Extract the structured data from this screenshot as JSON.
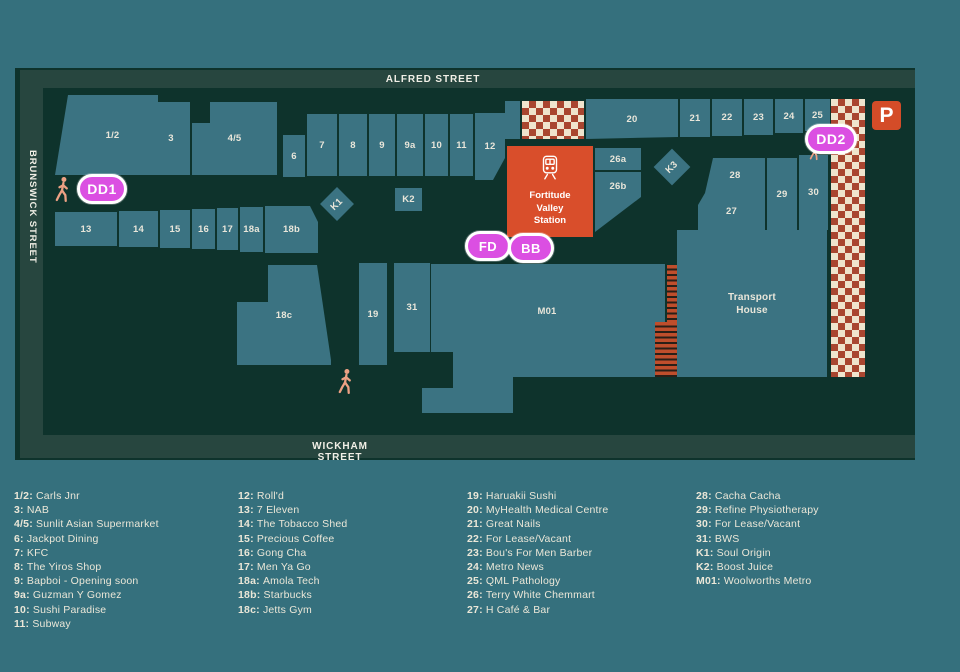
{
  "colors": {
    "bg": "#35707d",
    "map": "#0e332c",
    "band": "#27463f",
    "bld": "#3b7382",
    "label": "#e9e6da",
    "station": "#d94e2b",
    "checkerred": "#a94630",
    "checkercream": "#efe4cd",
    "stair": "#bf4e2c",
    "marker": "#db4fe2",
    "parking": "#d44c28",
    "person": "#eda184",
    "legendtext": "#ebe7d8"
  },
  "streets": {
    "top": "ALFRED STREET",
    "left": "BRUNSWICK STREET",
    "bottom": "WICKHAM STREET"
  },
  "station": {
    "name": "Fortitude\nValley\nStation"
  },
  "transport_house": {
    "name": "Transport\nHouse"
  },
  "parking": {
    "label": "P"
  },
  "markers": {
    "dd1": "DD1",
    "dd2": "DD2",
    "fd": "FD",
    "bb": "BB"
  },
  "buildings": {
    "u1_2": "1/2",
    "u3": "3",
    "u4_5": "4/5",
    "u6": "6",
    "u7": "7",
    "u8": "8",
    "u9": "9",
    "u9a": "9a",
    "u10": "10",
    "u11": "11",
    "u12": "12",
    "u13": "13",
    "u14": "14",
    "u15": "15",
    "u16": "16",
    "u17": "17",
    "u18a": "18a",
    "u18b": "18b",
    "u18c": "18c",
    "u19": "19",
    "u20": "20",
    "u21": "21",
    "u22": "22",
    "u23": "23",
    "u24": "24",
    "u25": "25",
    "u26a": "26a",
    "u26b": "26b",
    "u27": "27",
    "u28": "28",
    "u29": "29",
    "u30": "30",
    "u31": "31",
    "m01": "M01",
    "k1": "K1",
    "k2": "K2",
    "k3": "K3"
  },
  "legend": {
    "columns": [
      [
        {
          "n": "1/2",
          "t": "Carls Jnr"
        },
        {
          "n": "3",
          "t": "NAB"
        },
        {
          "n": "4/5",
          "t": "Sunlit Asian Supermarket"
        },
        {
          "n": "6",
          "t": "Jackpot Dining"
        },
        {
          "n": "7",
          "t": "KFC"
        },
        {
          "n": "8",
          "t": "The Yiros Shop"
        },
        {
          "n": "9",
          "t": "Bapboi - Opening soon"
        },
        {
          "n": "9a",
          "t": "Guzman Y Gomez"
        },
        {
          "n": "10",
          "t": "Sushi Paradise"
        },
        {
          "n": "11",
          "t": "Subway"
        }
      ],
      [
        {
          "n": "12",
          "t": "Roll'd"
        },
        {
          "n": "13",
          "t": "7 Eleven"
        },
        {
          "n": "14",
          "t": "The Tobacco Shed"
        },
        {
          "n": "15",
          "t": "Precious Coffee"
        },
        {
          "n": "16",
          "t": "Gong Cha"
        },
        {
          "n": "17",
          "t": "Men Ya Go"
        },
        {
          "n": "18a",
          "t": "Amola Tech"
        },
        {
          "n": "18b",
          "t": "Starbucks"
        },
        {
          "n": "18c",
          "t": "Jetts Gym"
        }
      ],
      [
        {
          "n": "19",
          "t": "Haruakii Sushi"
        },
        {
          "n": "20",
          "t": "MyHealth Medical Centre"
        },
        {
          "n": "21",
          "t": "Great Nails"
        },
        {
          "n": "22",
          "t": "For Lease/Vacant"
        },
        {
          "n": "23",
          "t": "Bou's For Men Barber"
        },
        {
          "n": "24",
          "t": "Metro News"
        },
        {
          "n": "25",
          "t": "QML Pathology"
        },
        {
          "n": "26",
          "t": "Terry White Chemmart"
        },
        {
          "n": "27",
          "t": "H Café & Bar"
        }
      ],
      [
        {
          "n": "28",
          "t": "Cacha Cacha"
        },
        {
          "n": "29",
          "t": "Refine Physiotherapy"
        },
        {
          "n": "30",
          "t": "For Lease/Vacant"
        },
        {
          "n": "31",
          "t": "BWS"
        },
        {
          "n": "K1",
          "t": "Soul Origin"
        },
        {
          "n": "K2",
          "t": "Boost Juice"
        },
        {
          "n": "M01",
          "t": "Woolworths Metro"
        }
      ]
    ]
  }
}
